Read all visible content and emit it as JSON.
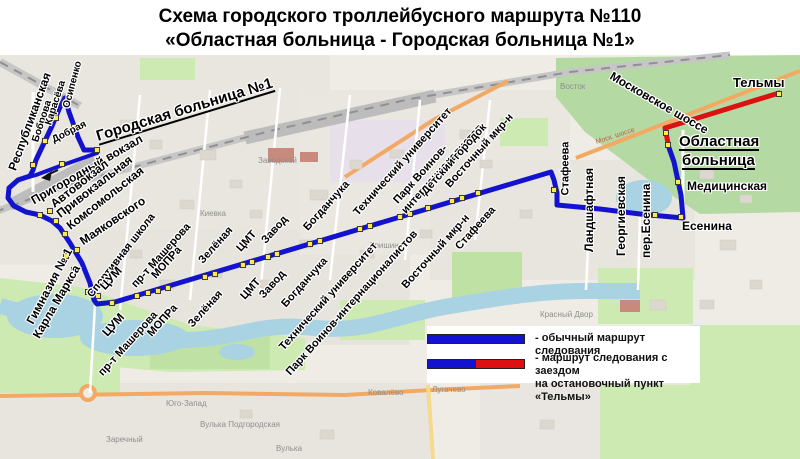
{
  "title": {
    "line1": "Схема городского троллейбусного маршрута №110",
    "line2": "«Областная больница - Городская больница №1»"
  },
  "legend": {
    "item1_label": "- обычный маршрут следования",
    "item2_label_line1": "- маршрут следования с заездом",
    "item2_label_line2": "на остановочный пункт «Тельмы»"
  },
  "colors": {
    "route_blue": "#1212cf",
    "route_red": "#dd1111",
    "stop_fill": "#ffe84d",
    "stop_border": "#3a3a3a"
  },
  "routes": {
    "main": [
      [
        97,
        150
      ],
      [
        84,
        150
      ],
      [
        78,
        137
      ],
      [
        69,
        112
      ],
      [
        65,
        98
      ],
      [
        60,
        107
      ],
      [
        52,
        126
      ],
      [
        44,
        143
      ],
      [
        36,
        160
      ],
      [
        33,
        170
      ],
      [
        30,
        176
      ],
      [
        18,
        180
      ],
      [
        9,
        188
      ],
      [
        8,
        198
      ],
      [
        14,
        206
      ],
      [
        26,
        212
      ],
      [
        40,
        215
      ],
      [
        52,
        221
      ],
      [
        60,
        228
      ],
      [
        70,
        243
      ],
      [
        82,
        263
      ],
      [
        90,
        283
      ],
      [
        94,
        300
      ],
      [
        97,
        304
      ],
      [
        115,
        302
      ],
      [
        551,
        172
      ],
      [
        554,
        180
      ],
      [
        557,
        193
      ],
      [
        557,
        205
      ],
      [
        600,
        209
      ],
      [
        640,
        214
      ],
      [
        683,
        218
      ],
      [
        681,
        195
      ],
      [
        674,
        162
      ],
      [
        668,
        145
      ]
    ],
    "back": [
      [
        97,
        153
      ],
      [
        60,
        166
      ],
      [
        36,
        175
      ],
      [
        18,
        180
      ]
    ],
    "red": [
      [
        668,
        143
      ],
      [
        665,
        128
      ],
      [
        779,
        93
      ]
    ]
  },
  "stops": [
    {
      "name": "Городская больница №1",
      "x": 97,
      "y": 150
    },
    {
      "name": "Добрая",
      "x": 74,
      "y": 127
    },
    {
      "name": "Осипенко",
      "x": 64,
      "y": 104
    },
    {
      "name": "Карасёва",
      "x": 56,
      "y": 118
    },
    {
      "name": "Боброва",
      "x": 45,
      "y": 141
    },
    {
      "name": "Республиканская",
      "x": 33,
      "y": 165
    },
    {
      "name": "Пригородный вокзал",
      "x": 62,
      "y": 164
    },
    {
      "name": "Пригородный вокзал",
      "x": 40,
      "y": 215
    },
    {
      "name": "Автовокзал",
      "x": 50,
      "y": 211
    },
    {
      "name": "Привокзальная",
      "x": 56,
      "y": 221
    },
    {
      "name": "Комсомольская",
      "x": 65,
      "y": 234
    },
    {
      "name": "Маяковского",
      "x": 77,
      "y": 250
    },
    {
      "name": "Гимназия № 1",
      "x": 66,
      "y": 256
    },
    {
      "name": "Карла Маркса",
      "x": 74,
      "y": 270
    },
    {
      "name": "Спортивная школа",
      "x": 88,
      "y": 292
    },
    {
      "name": "ЦУМ",
      "x": 98,
      "y": 296
    },
    {
      "name": "ЦУМ",
      "x": 112,
      "y": 303
    },
    {
      "name": "пр-т Машерова",
      "x": 137,
      "y": 296
    },
    {
      "name": "пр-т Машерова",
      "x": 148,
      "y": 293
    },
    {
      "name": "МОПРа",
      "x": 158,
      "y": 291
    },
    {
      "name": "МОПРа",
      "x": 168,
      "y": 288
    },
    {
      "name": "Зелёная",
      "x": 205,
      "y": 277
    },
    {
      "name": "Зелёная",
      "x": 215,
      "y": 274
    },
    {
      "name": "ЦМТ",
      "x": 243,
      "y": 265
    },
    {
      "name": "ЦМТ",
      "x": 252,
      "y": 262
    },
    {
      "name": "Завод",
      "x": 268,
      "y": 257
    },
    {
      "name": "Завод",
      "x": 277,
      "y": 254
    },
    {
      "name": "Богданчука",
      "x": 310,
      "y": 244
    },
    {
      "name": "Богданчука",
      "x": 320,
      "y": 241
    },
    {
      "name": "Технический университет",
      "x": 360,
      "y": 229
    },
    {
      "name": "Технический университет",
      "x": 370,
      "y": 226
    },
    {
      "name": "Парк Воинов-интернационалистов",
      "x": 400,
      "y": 217
    },
    {
      "name": "Парк Воинов-интернационалистов",
      "x": 410,
      "y": 214
    },
    {
      "name": "Детский городок",
      "x": 428,
      "y": 208
    },
    {
      "name": "Восточный мкр-н",
      "x": 452,
      "y": 201
    },
    {
      "name": "Восточный мкр-н",
      "x": 462,
      "y": 198
    },
    {
      "name": "Стафеева",
      "x": 478,
      "y": 193
    },
    {
      "name": "Стафеева",
      "x": 554,
      "y": 190
    },
    {
      "name": "Ландшафтная",
      "x": 590,
      "y": 208
    },
    {
      "name": "Георгиевская",
      "x": 622,
      "y": 212
    },
    {
      "name": "пер.Есенина",
      "x": 655,
      "y": 215
    },
    {
      "name": "Есенина",
      "x": 681,
      "y": 217
    },
    {
      "name": "Медицинская",
      "x": 678,
      "y": 182
    },
    {
      "name": "Областная больница",
      "x": 668,
      "y": 145
    },
    {
      "name": "развилка Тельмы",
      "x": 666,
      "y": 133
    },
    {
      "name": "Тельмы",
      "x": 779,
      "y": 94
    }
  ],
  "stop_labels": [
    {
      "text": "Республиканская",
      "x": 12,
      "y": 172,
      "r": -70,
      "s": 12,
      "a": "start"
    },
    {
      "text": "Боброва",
      "x": 36,
      "y": 144,
      "r": -72,
      "s": 10,
      "a": "start"
    },
    {
      "text": "Карасёва",
      "x": 49,
      "y": 127,
      "r": -72,
      "s": 10,
      "a": "start"
    },
    {
      "text": "Осипенко",
      "x": 67,
      "y": 110,
      "r": -75,
      "s": 10,
      "a": "start"
    },
    {
      "text": "Добрая",
      "x": 53,
      "y": 143,
      "r": -27,
      "s": 10,
      "a": "start"
    },
    {
      "text": "Городская больница №1",
      "x": 97,
      "y": 139,
      "r": -17,
      "s": 15,
      "a": "start",
      "u": true
    },
    {
      "text": "Пригородный вокзал",
      "x": 32,
      "y": 203,
      "r": -30,
      "s": 12,
      "a": "start"
    },
    {
      "text": "Автовокзал",
      "x": 52,
      "y": 207,
      "r": -38,
      "s": 12,
      "a": "start"
    },
    {
      "text": "Привокзальная",
      "x": 58,
      "y": 217,
      "r": -38,
      "s": 12,
      "a": "start"
    },
    {
      "text": "Комсомольская",
      "x": 68,
      "y": 229,
      "r": -38,
      "s": 12,
      "a": "start"
    },
    {
      "text": "Маяковского",
      "x": 81,
      "y": 244,
      "r": -34,
      "s": 12,
      "a": "start"
    },
    {
      "text": "Гимназия № 1",
      "x": 69,
      "y": 251,
      "r": -62,
      "s": 12,
      "a": "end"
    },
    {
      "text": "Карла Маркса",
      "x": 77,
      "y": 268,
      "r": -60,
      "s": 12,
      "a": "end"
    },
    {
      "text": "Спортивная школа",
      "x": 90,
      "y": 298,
      "r": -52,
      "s": 11,
      "a": "start"
    },
    {
      "text": "ЦУМ",
      "x": 102,
      "y": 290,
      "r": -48,
      "s": 12,
      "a": "start"
    },
    {
      "text": "ЦУМ",
      "x": 122,
      "y": 317,
      "r": -48,
      "s": 12,
      "a": "end"
    },
    {
      "text": "пр-т Машерова",
      "x": 134,
      "y": 288,
      "r": -48,
      "s": 11,
      "a": "start"
    },
    {
      "text": "пр-т Машерова",
      "x": 156,
      "y": 315,
      "r": -48,
      "s": 11,
      "a": "end"
    },
    {
      "text": "МОПРа",
      "x": 154,
      "y": 279,
      "r": -48,
      "s": 11,
      "a": "start"
    },
    {
      "text": "МОПРа",
      "x": 176,
      "y": 308,
      "r": -48,
      "s": 11,
      "a": "end"
    },
    {
      "text": "Зелёная",
      "x": 201,
      "y": 264,
      "r": -48,
      "s": 11,
      "a": "start"
    },
    {
      "text": "Зелёная",
      "x": 221,
      "y": 294,
      "r": -48,
      "s": 11,
      "a": "end"
    },
    {
      "text": "ЦМТ",
      "x": 239,
      "y": 252,
      "r": -48,
      "s": 11,
      "a": "start"
    },
    {
      "text": "ЦМТ",
      "x": 259,
      "y": 282,
      "r": -48,
      "s": 11,
      "a": "end"
    },
    {
      "text": "Завод",
      "x": 264,
      "y": 244,
      "r": -48,
      "s": 11,
      "a": "start"
    },
    {
      "text": "Завод",
      "x": 284,
      "y": 274,
      "r": -48,
      "s": 11,
      "a": "end"
    },
    {
      "text": "Богданчука",
      "x": 306,
      "y": 231,
      "r": -48,
      "s": 11,
      "a": "start"
    },
    {
      "text": "Богданчука",
      "x": 326,
      "y": 261,
      "r": -48,
      "s": 11,
      "a": "end"
    },
    {
      "text": "Технический университет",
      "x": 356,
      "y": 216,
      "r": -48,
      "s": 11,
      "a": "start"
    },
    {
      "text": "Технический университет",
      "x": 376,
      "y": 246,
      "r": -48,
      "s": 11,
      "a": "end"
    },
    {
      "text": "Парк Воинов-",
      "x": 396,
      "y": 204,
      "r": -48,
      "s": 11,
      "a": "start"
    },
    {
      "text": "интернационалистов",
      "x": 404,
      "y": 214,
      "r": -48,
      "s": 11,
      "a": "start"
    },
    {
      "text": "Парк Воинов-интернационалистов",
      "x": 416,
      "y": 234,
      "r": -48,
      "s": 11,
      "a": "end"
    },
    {
      "text": "Детский городок",
      "x": 424,
      "y": 195,
      "r": -48,
      "s": 11,
      "a": "start"
    },
    {
      "text": "Восточный мкр-н",
      "x": 448,
      "y": 188,
      "r": -48,
      "s": 11,
      "a": "start"
    },
    {
      "text": "Восточный мкр-н",
      "x": 468,
      "y": 218,
      "r": -48,
      "s": 11,
      "a": "end"
    },
    {
      "text": "Стафеева",
      "x": 494,
      "y": 210,
      "r": -48,
      "s": 11,
      "a": "end"
    },
    {
      "text": "Стафеева",
      "x": 566,
      "y": 197,
      "r": -90,
      "s": 11,
      "a": "start"
    },
    {
      "text": "Ландшафтная",
      "x": 589,
      "y": 254,
      "r": -90,
      "s": 12,
      "a": "start"
    },
    {
      "text": "Георгиевская",
      "x": 621,
      "y": 258,
      "r": -90,
      "s": 12,
      "a": "start"
    },
    {
      "text": "пер.Есенина",
      "x": 646,
      "y": 260,
      "r": -90,
      "s": 12,
      "a": "start"
    },
    {
      "text": "Есенина",
      "x": 682,
      "y": 228,
      "r": 0,
      "s": 12,
      "a": "start"
    },
    {
      "text": "Медицинская",
      "x": 687,
      "y": 188,
      "r": 0,
      "s": 12,
      "a": "start"
    },
    {
      "text": "Областная",
      "x": 679,
      "y": 144,
      "r": 0,
      "s": 15,
      "a": "start",
      "u": true
    },
    {
      "text": "больница",
      "x": 682,
      "y": 163,
      "r": 0,
      "s": 15,
      "a": "start",
      "u": true
    },
    {
      "text": "Тельмы",
      "x": 733,
      "y": 84,
      "r": 0,
      "s": 13,
      "a": "start"
    },
    {
      "text": "Московское шоссе",
      "x": 611,
      "y": 77,
      "r": 30,
      "s": 12,
      "a": "start"
    }
  ],
  "map_labels": [
    {
      "text": "Киевка",
      "x": 200,
      "y": 215,
      "s": 8,
      "c": "#8e8e8e"
    },
    {
      "text": "Заводской",
      "x": 258,
      "y": 162,
      "s": 8,
      "c": "#8e8e8e"
    },
    {
      "text": "Тришин",
      "x": 370,
      "y": 247,
      "s": 8,
      "c": "#8e8e8e"
    },
    {
      "text": "Восток",
      "x": 560,
      "y": 88,
      "s": 8,
      "c": "#8e8e8e"
    },
    {
      "text": "Красный Двор",
      "x": 540,
      "y": 316,
      "s": 8,
      "c": "#8e8e8e"
    },
    {
      "text": "Юго-Запад",
      "x": 166,
      "y": 405,
      "s": 8,
      "c": "#8e8e8e"
    },
    {
      "text": "Вулька Подгородская",
      "x": 200,
      "y": 426,
      "s": 8,
      "c": "#8e8e8e"
    },
    {
      "text": "Заречный",
      "x": 106,
      "y": 441,
      "s": 8,
      "c": "#8e8e8e"
    },
    {
      "text": "Вулька",
      "x": 276,
      "y": 450,
      "s": 8,
      "c": "#8e8e8e"
    },
    {
      "text": "Лугачево",
      "x": 432,
      "y": 391,
      "s": 8,
      "c": "#8e8e8e"
    },
    {
      "text": "Ковалёво",
      "x": 368,
      "y": 394,
      "s": 8,
      "c": "#8e8e8e"
    },
    {
      "text": "Моск. шоссе",
      "x": 596,
      "y": 144,
      "s": 7,
      "c": "#c05a4a",
      "r": -18
    }
  ]
}
